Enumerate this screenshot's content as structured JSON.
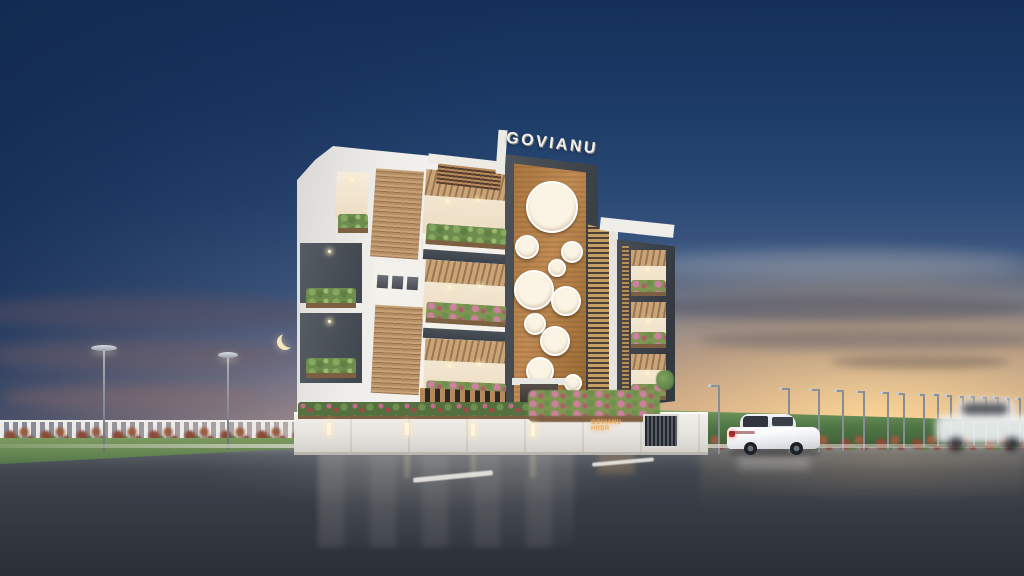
{
  "scene": {
    "type": "architectural-exterior-render",
    "subject": "GOVIANU apartment building beside a highway",
    "time_of_day": "dusk",
    "rooftop_sign": "GOVIANU",
    "wall_sign": "GOVIANU HRBR",
    "colors": {
      "sky_top": "#14305a",
      "sky_mid": "#4a6288",
      "sunset_glow": "#f5c98e",
      "horizon_cream": "#f2debc",
      "cloud_slate": "#565d72",
      "building_white": "#f4f2ee",
      "frame_gray": "#464c53",
      "terracotta_panel": "#b5804a",
      "wood_slat": "#c7a065",
      "plant_green": "#6f8f4f",
      "flower_pink": "#cf7fa0",
      "hedge_green": "#527a46",
      "road_asphalt": "#3a4049",
      "lane_marking": "#e8e6e0",
      "moon": "#f6e7bd",
      "car_white": "#f2f3f4",
      "wall_sign_glow": "#eab269"
    },
    "objects": [
      "crescent-moon",
      "white-sedan",
      "motion-blurred-car",
      "picket-fence",
      "street-lamps",
      "hedge-wall",
      "compound-wall",
      "entrance-gate",
      "planters"
    ],
    "left_lamps": [
      {
        "x": 104,
        "top": 350,
        "h": 102,
        "cap": 26
      },
      {
        "x": 228,
        "top": 357,
        "h": 93,
        "cap": 20
      }
    ],
    "right_lamps": [
      {
        "x": 718,
        "top": 385,
        "h": 68,
        "arm": 10
      },
      {
        "x": 788,
        "top": 388,
        "h": 64,
        "arm": 9
      },
      {
        "x": 818,
        "top": 389,
        "h": 62,
        "arm": 9
      },
      {
        "x": 842,
        "top": 390,
        "h": 60,
        "arm": 8
      },
      {
        "x": 863,
        "top": 391,
        "h": 58,
        "arm": 8
      },
      {
        "x": 887,
        "top": 392,
        "h": 56,
        "arm": 7
      },
      {
        "x": 903,
        "top": 393,
        "h": 54,
        "arm": 7
      },
      {
        "x": 923,
        "top": 394,
        "h": 52,
        "arm": 6
      },
      {
        "x": 937,
        "top": 394,
        "h": 51,
        "arm": 6
      },
      {
        "x": 950,
        "top": 395,
        "h": 50,
        "arm": 6
      },
      {
        "x": 962,
        "top": 396,
        "h": 49,
        "arm": 5
      },
      {
        "x": 973,
        "top": 396,
        "h": 48,
        "arm": 5
      },
      {
        "x": 985,
        "top": 397,
        "h": 47,
        "arm": 5
      },
      {
        "x": 997,
        "top": 397,
        "h": 46,
        "arm": 5
      },
      {
        "x": 1008,
        "top": 398,
        "h": 45,
        "arm": 4
      },
      {
        "x": 1019,
        "top": 398,
        "h": 44,
        "arm": 4
      }
    ],
    "tower_circles": [
      {
        "cx": 550,
        "cy": 205,
        "r": 24
      },
      {
        "cx": 525,
        "cy": 245,
        "r": 10
      },
      {
        "cx": 570,
        "cy": 250,
        "r": 9
      },
      {
        "cx": 555,
        "cy": 266,
        "r": 7
      },
      {
        "cx": 532,
        "cy": 288,
        "r": 18
      },
      {
        "cx": 564,
        "cy": 299,
        "r": 13
      },
      {
        "cx": 533,
        "cy": 322,
        "r": 9
      },
      {
        "cx": 553,
        "cy": 339,
        "r": 13
      },
      {
        "cx": 538,
        "cy": 369,
        "r": 12
      },
      {
        "cx": 571,
        "cy": 381,
        "r": 7
      }
    ]
  }
}
